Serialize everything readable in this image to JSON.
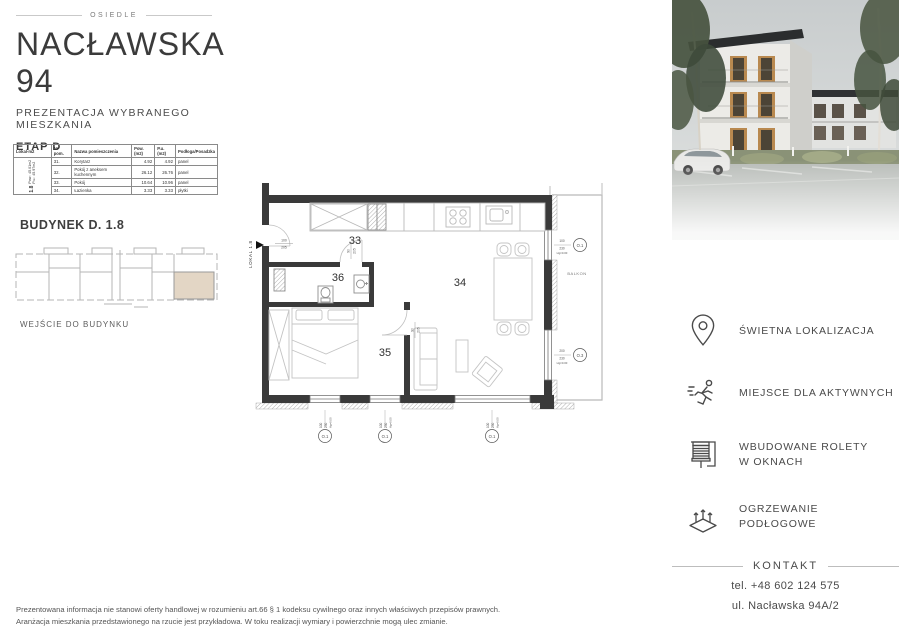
{
  "header": {
    "osiedle": "OSIEDLE",
    "title": "NACŁAWSKA 94",
    "subtitle": "PREZENTACJA WYBRANEGO MIESZKANIA",
    "stage": "ETAP D"
  },
  "table": {
    "headers": {
      "lokal": "Lokal-m2",
      "nr": "Nr pom.",
      "name": "Nazwa pomieszczenia",
      "pow": "Pow.(m2)",
      "pu": "P.u.(m2)",
      "floor": "Podłoga/Posadzka"
    },
    "unit": {
      "id": "1.8",
      "pow": "Pow.: 45.01m2",
      "pu": "P.u.: 45.97m2"
    },
    "rows": [
      {
        "nr": "31.",
        "name": "Korytarz",
        "pow": "4.92",
        "pu": "4.92",
        "floor": "panel"
      },
      {
        "nr": "32.",
        "name": "Pokój z aneksem kuchennym",
        "pow": "26.12",
        "pu": "26.76",
        "floor": "panel"
      },
      {
        "nr": "33.",
        "name": "Pokój",
        "pow": "10.64",
        "pu": "10.96",
        "floor": "panel"
      },
      {
        "nr": "34.",
        "name": "Łazienka",
        "pow": "3.33",
        "pu": "3.33",
        "floor": "płytki"
      }
    ]
  },
  "building": {
    "title": "BUDYNEK D. 1.8",
    "entrance": "WEJŚCIE DO BUDYNKU"
  },
  "plan": {
    "lokal": "LOKAL 1.8",
    "balkon": "BALKON",
    "room33": "33",
    "room34": "34",
    "room35": "35",
    "room36": "36",
    "dim100": "100",
    "dim205": "205",
    "dim90": "90",
    "dim200": "200",
    "dim230": "230",
    "hg": "Hg=0.00",
    "o1": "O.1",
    "o3": "O.3"
  },
  "features": [
    {
      "icon": "location-pin-icon",
      "lines": [
        "ŚWIETNA LOKALIZACJA"
      ]
    },
    {
      "icon": "runner-icon",
      "lines": [
        "MIEJSCE DLA AKTYWNYCH"
      ]
    },
    {
      "icon": "roller-blinds-icon",
      "lines": [
        "WBUDOWANE ROLETY",
        "W OKNACH"
      ]
    },
    {
      "icon": "floor-heating-icon",
      "lines": [
        "OGRZEWANIE PODŁOGOWE"
      ]
    }
  ],
  "contact": {
    "title": "KONTAKT",
    "phone": "tel. +48 602 124 575",
    "address": "ul. Nacławska 94A/2"
  },
  "footer": {
    "line1": "Prezentowana informacja nie stanowi oferty handlowej w rozumieniu art.66 § 1 kodeksu cywilnego oraz innych właściwych przepisów prawnych.",
    "line2": "Aranżacja mieszkania przedstawionego na rzucie jest przykładowa. W toku realizacji wymiary i powierzchnie mogą ulec zmianie."
  },
  "colors": {
    "highlight_beige": "#e3d6c5",
    "wall": "#3a3a3a",
    "text": "#4a4a4a"
  }
}
